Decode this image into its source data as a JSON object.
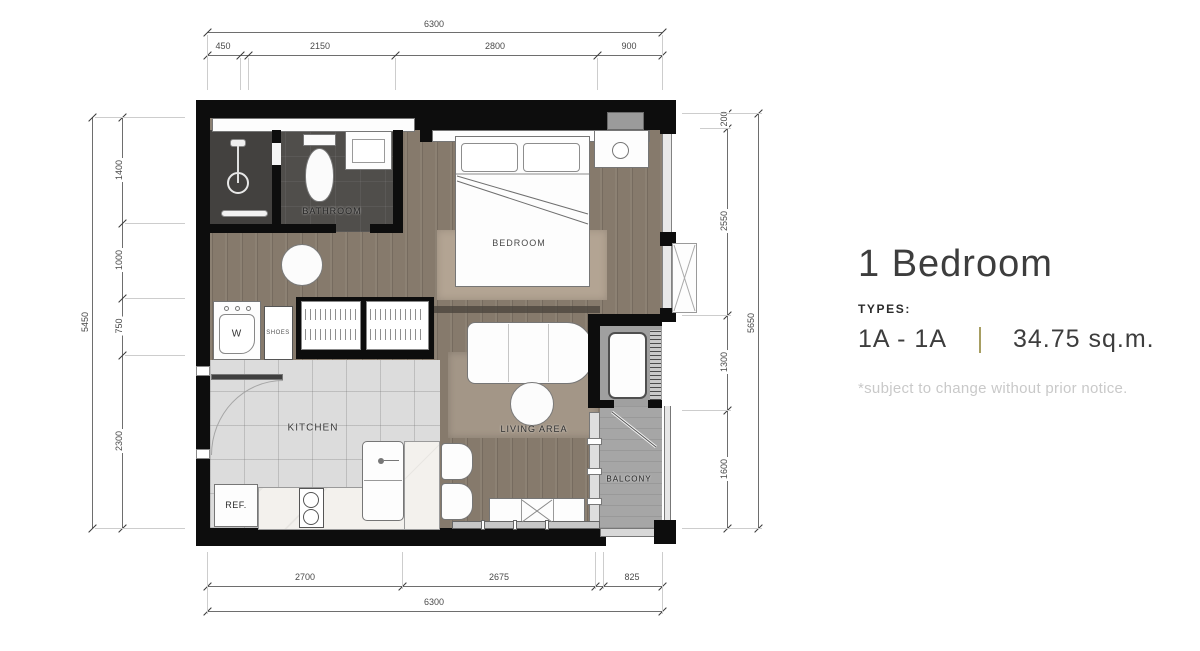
{
  "info": {
    "title": "1 Bedroom",
    "types_label": "TYPES:",
    "type_value": "1A - 1A",
    "area": "34.75 sq.m.",
    "disclaimer": "*subject to change without prior notice.",
    "divider_color": "#a79e62"
  },
  "plan_labels": {
    "bathroom": "BATHROOM",
    "bedroom": "BEDROOM",
    "kitchen": "KITCHEN",
    "living": "LIVING AREA",
    "balcony": "BALCONY",
    "washer": "W",
    "shoes": "SHOES",
    "fridge": "REF."
  },
  "dims": {
    "top": {
      "total": "6300",
      "segments": [
        "450",
        "2150",
        "2800",
        "900"
      ]
    },
    "bottom": {
      "total": "6300",
      "segments": [
        "2700",
        "2675",
        "825"
      ]
    },
    "left": {
      "total": "5450",
      "segments": [
        "1400",
        "1000",
        "750",
        "2300"
      ]
    },
    "right": {
      "total": "5650",
      "segments": [
        "200",
        "2550",
        "1300",
        "1600"
      ]
    }
  },
  "colors": {
    "wall": "#0d0d0d",
    "wood_floor": "#867a6c",
    "tile_floor": "#dcdcdc",
    "bath_floor": "#504e4b",
    "balcony_floor": "#a6a6a6",
    "rug": "#b3a493",
    "accent_divider": "#a79e62"
  }
}
